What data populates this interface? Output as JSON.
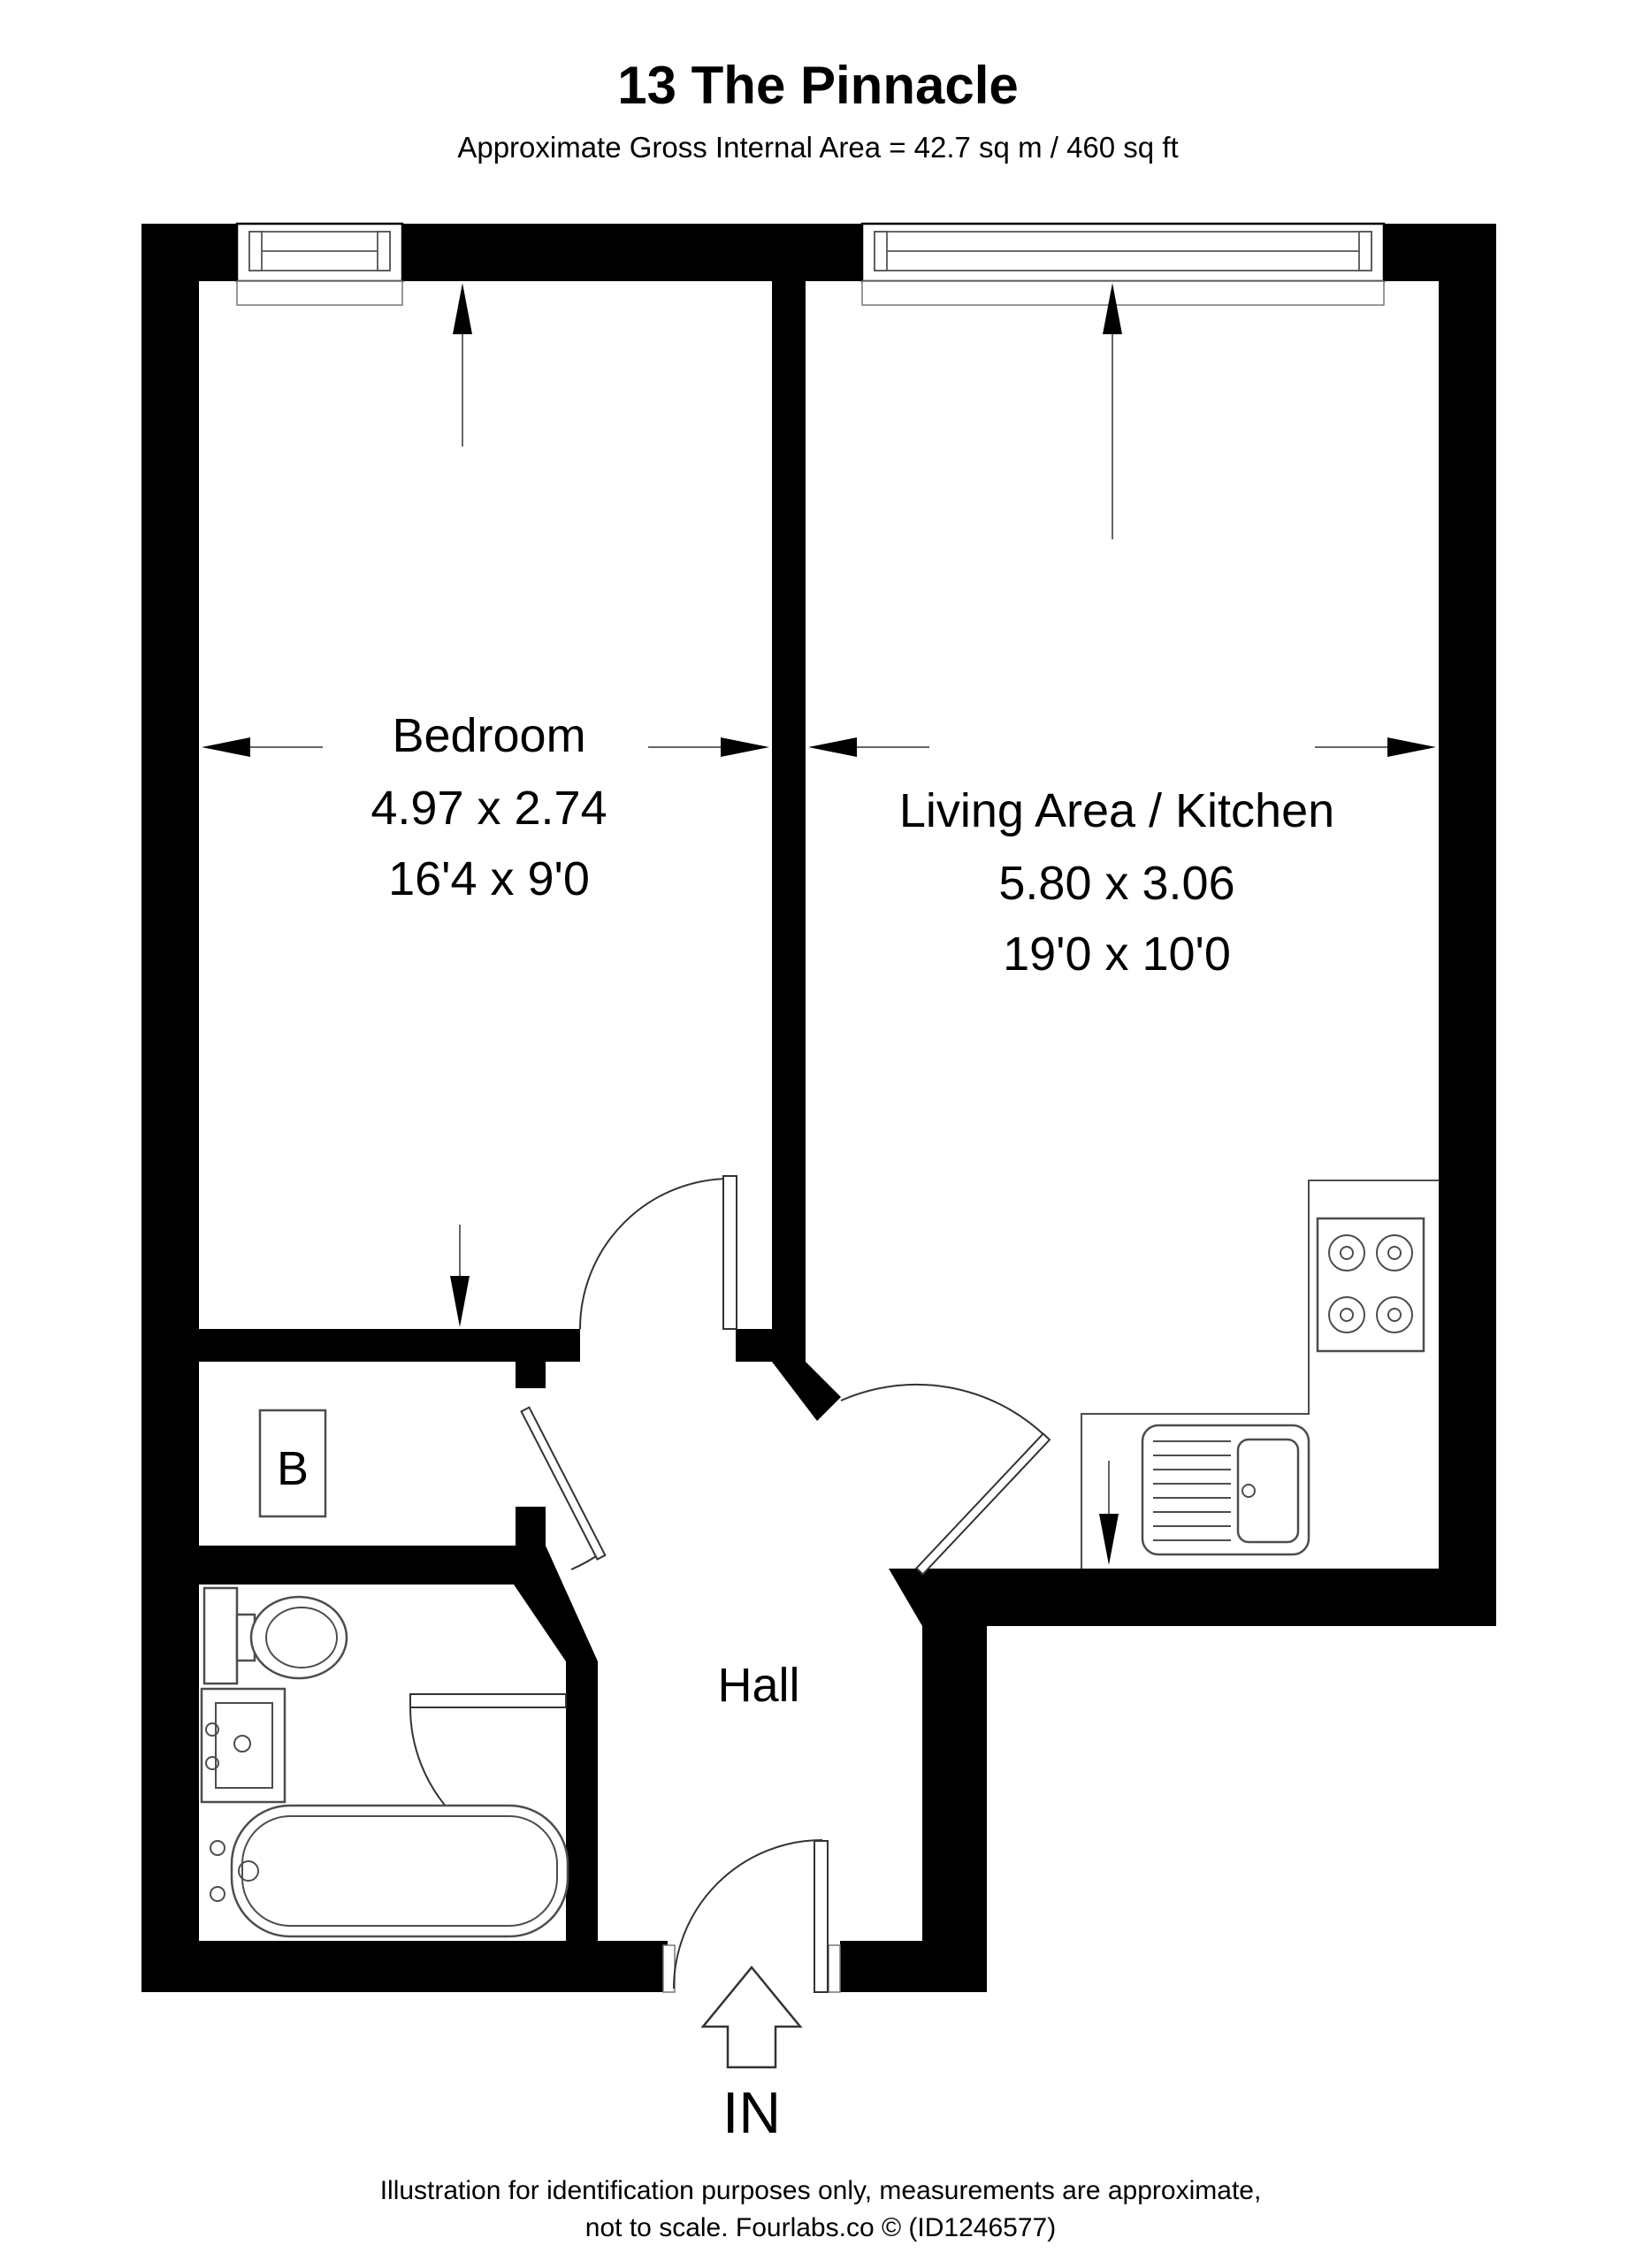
{
  "header": {
    "title": "13 The Pinnacle",
    "subtitle": "Approximate Gross Internal Area = 42.7 sq m / 460 sq ft"
  },
  "rooms": {
    "bedroom": {
      "name": "Bedroom",
      "dims_metric": "4.97 x 2.74",
      "dims_imperial": "16'4 x 9'0"
    },
    "living": {
      "name": "Living Area / Kitchen",
      "dims_metric": "5.80 x 3.06",
      "dims_imperial": "19'0 x 10'0"
    },
    "hall": {
      "name": "Hall"
    },
    "cupboard": {
      "name": "B"
    }
  },
  "entrance": {
    "label": "IN"
  },
  "footer": {
    "line1": "Illustration for identification purposes only, measurements are approximate,",
    "line2": "not to scale. Fourlabs.co © (ID1246577)"
  },
  "colors": {
    "walls": "#000000",
    "background": "#ffffff",
    "fixtures": "#4d4d4d",
    "door_lines": "#333333"
  }
}
